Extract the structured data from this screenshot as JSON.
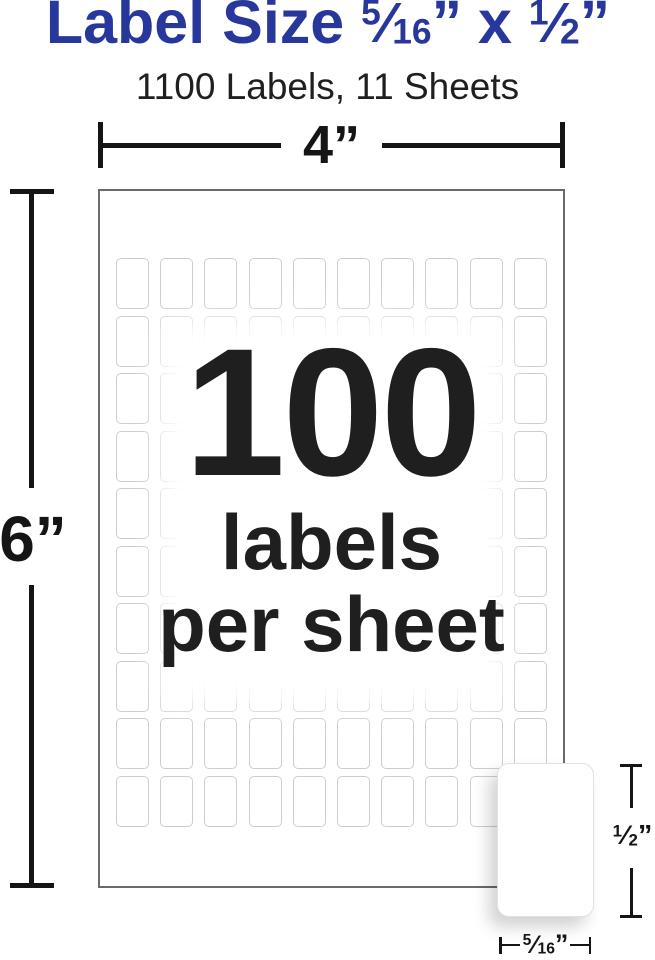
{
  "title": {
    "prefix": "Label Size ",
    "frac_a_num": "5",
    "frac_a_den": "16",
    "times": " x ",
    "frac_b_num": "1",
    "frac_b_den": "2",
    "slash": "⁄",
    "inch_mark": "”"
  },
  "subtitle": "1100 Labels, 11 Sheets",
  "sheet": {
    "big_count": "100",
    "caption_line1": "labels",
    "caption_line2": "per sheet",
    "grid_rows": 10,
    "grid_cols": 10
  },
  "dims": {
    "width_label": "4”",
    "height_label": "6”",
    "label_height_num": "1",
    "label_height_den": "2",
    "label_width_num": "5",
    "label_width_den": "16",
    "slash": "⁄",
    "inch_mark": "”"
  },
  "colors": {
    "brand-blue": "#28379b",
    "text-dark": "#1f1f1f",
    "dim-black": "#151515",
    "sheet-border": "#6a6a6a",
    "cell-border": "#cdcdcd"
  }
}
